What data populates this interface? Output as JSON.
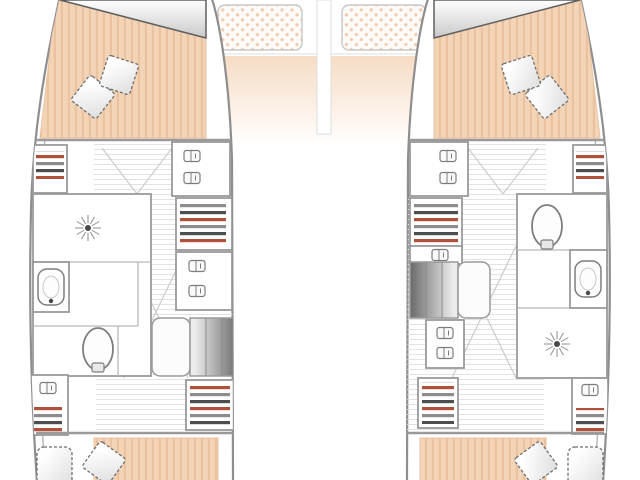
{
  "meta": {
    "title": "Catamaran yacht hull-deck floor plan, top-down view, symmetrical port and starboard hulls",
    "visible_text": "none",
    "view": "top-down blueprint drawing"
  },
  "colors": {
    "background": "#ffffff",
    "hull_line": "#8e8e8e",
    "hull_inner_line": "#b5b5b5",
    "wall": "#9a9a9a",
    "wall_light": "#b8b8b8",
    "plank_line": "#e2e2e2",
    "swing_line": "#cccccc",
    "mattress": "#f4d4b6",
    "mattress_stripe": "#eac2a0",
    "deck_top": "#f6dcc4",
    "tramp_bg": "#fdfaf7",
    "tramp_dot": "#efcbb0",
    "pillow_light": "#ffffff",
    "pillow_shade": "#dedede",
    "pillow_edge": "#6f6f6f",
    "fixture_line": "#7d7d7d",
    "stripe_dark": "#4e4e4e",
    "stripe_red": "#b0523b",
    "stripe_gray": "#8c8c8c",
    "stairs_light": "#ececec",
    "stairs_dark": "#6a6a6a",
    "head_dark": "#c9c9c9",
    "head_edge": "#5f5f5f",
    "icon_core": "#4a4a4a",
    "icon_ray": "#8f8f8f"
  },
  "foredeck": {
    "trampoline_port": "dot-mesh netting panel",
    "trampoline_starboard": "dot-mesh netting panel",
    "deck_band": "peach-to-white faded foredeck"
  },
  "port_hull": {
    "forward_cabin": {
      "bed": "double berth mattress",
      "pillows": 2,
      "head_panel": "triangular shaded panel"
    },
    "midship": {
      "wardrobe_shelf_unit": "striped shelves",
      "shower_room": "starburst shower head symbol",
      "vanity_sink": "bowl with tap",
      "toilet": "oval bowl with hinge",
      "inboard_cabinets": 2,
      "inboard_shelf_units": 2,
      "companionway_stairs": "3-tread gradient staircase with landing"
    },
    "aft_cabin": {
      "bed": "double berth mattress",
      "pillows": 2,
      "cabinet": "latched locker with shelves"
    }
  },
  "starboard_hull": {
    "forward_cabin": {
      "bed": "double berth mattress",
      "pillows": 2,
      "head_panel": "triangular shaded panel"
    },
    "midship": {
      "wardrobe_shelf_unit": "striped shelves",
      "toilet": "oval bowl with hinge",
      "vanity_sink": "bowl with tap",
      "shower_room": "starburst shower head symbol",
      "inboard_cabinets": 3,
      "inboard_shelf_units": 2,
      "companionway_stairs": "3-tread gradient staircase with landing"
    },
    "aft_cabin": {
      "bed": "double berth mattress",
      "pillows": 2,
      "cabinet": "latched locker with shelves"
    }
  },
  "icons": {
    "shower-icon": "starburst rays with dark core",
    "latch-icon": "rounded rectangle handle with divider",
    "toilet-icon": "oval bowl plus hinge block",
    "sink-icon": "rounded bowl with tap dot",
    "pillow-icon": "stitched-edge square cushion"
  }
}
